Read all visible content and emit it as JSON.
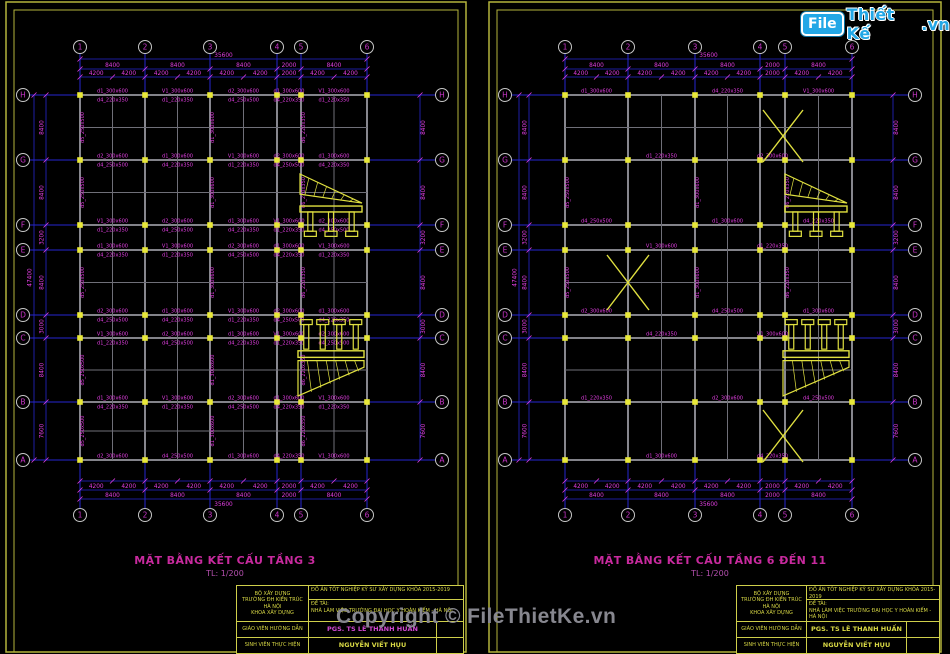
{
  "page": {
    "width": 950,
    "height": 654,
    "background": "#000000"
  },
  "logo": {
    "file": "File",
    "brand": "Thiết Kế",
    "tld": ".vn"
  },
  "watermark": {
    "text": "Copyright © FileThietKe.vn"
  },
  "colors": {
    "axis_line": "#2626cf",
    "dim_text": "#e23ee2",
    "beam": "#96969e",
    "beam_secondary": "#6f6f78",
    "column_fill": "#e8e838",
    "bubble_stroke": "#c6c6c6",
    "bubble_text": "#c835c8",
    "title_text": "#c82a9e",
    "sheet_border": "#b4b43c",
    "detail": "#e0e040",
    "watermark_text": "#87878f",
    "logo_blue": "#22a7e6"
  },
  "sheets": [
    {
      "title": "MẶT BẰNG KẾT CẤU TẦNG 3",
      "scale": "TL: 1/200",
      "plan": {
        "col_axes": [
          "1",
          "2",
          "3",
          "4",
          "5",
          "6"
        ],
        "row_axes": [
          "H",
          "G",
          "F",
          "E",
          "D",
          "C",
          "B",
          "A"
        ],
        "col_dims": [
          "8400",
          "8400",
          "8400",
          "2000",
          "8400"
        ],
        "col_subdims": [
          [
            "4200",
            "4200"
          ],
          [
            "4200",
            "4200"
          ],
          [
            "4200",
            "4200"
          ],
          [
            "2000"
          ],
          [
            "4200",
            "4200"
          ]
        ],
        "col_overall": "35600",
        "row_dims": [
          "8400",
          "8400",
          "3200",
          "8400",
          "3000",
          "8400",
          "7600"
        ],
        "row_overall": "47400",
        "dense": true,
        "beam_labels": [
          "d1_300x600",
          "d4_220x350",
          "V1_300x600",
          "d1_220x350",
          "d2_300x600",
          "d4_250x500"
        ],
        "beam_labels_v": [
          "d5_250x500",
          "d1_300x600",
          "d6_220x350"
        ]
      }
    },
    {
      "title": "MẶT BẰNG KẾT CẤU TẦNG 6 ĐẾN 11",
      "scale": "TL: 1/200",
      "plan": {
        "col_axes": [
          "1",
          "2",
          "3",
          "4",
          "5",
          "6"
        ],
        "row_axes": [
          "H",
          "G",
          "F",
          "E",
          "D",
          "C",
          "B",
          "A"
        ],
        "col_dims": [
          "8400",
          "8400",
          "8400",
          "2000",
          "8400"
        ],
        "col_subdims": [
          [
            "4200",
            "4200"
          ],
          [
            "4200",
            "4200"
          ],
          [
            "4200",
            "4200"
          ],
          [
            "2000"
          ],
          [
            "4200",
            "4200"
          ]
        ],
        "col_overall": "35600",
        "row_dims": [
          "8400",
          "8400",
          "3200",
          "8400",
          "3000",
          "8400",
          "7600"
        ],
        "row_overall": "47400",
        "dense": false,
        "beam_labels": [
          "d1_300x600",
          "d4_220x350",
          "V1_300x600",
          "d1_220x350",
          "d2_300x600",
          "d4_250x500"
        ],
        "beam_labels_v": [
          "d5_250x500",
          "d1_300x600",
          "d6_220x350"
        ]
      }
    }
  ],
  "titleblock": {
    "org": [
      "BỘ XÂY DỰNG",
      "TRƯỜNG ĐH KIẾN TRÚC",
      "HÀ NỘI",
      "KHOA XÂY DỰNG"
    ],
    "project": "ĐỒ ÁN TỐT NGHIỆP KỸ SƯ XÂY DỰNG KHÓA 2015-2019",
    "topic_label": "ĐỀ TÀI:",
    "topic": "NHÀ LÀM VIỆC TRƯỜNG ĐẠI HỌC Y HOÀN KIẾM - HÀ NỘI",
    "advisor_label": "GIÁO VIÊN HƯỚNG DẪN",
    "advisor": "PGS. TS LÊ THANH HUẤN",
    "student_label": "SINH VIÊN THỰC HIỆN",
    "student": "NGUYỄN VIẾT HỤU"
  }
}
